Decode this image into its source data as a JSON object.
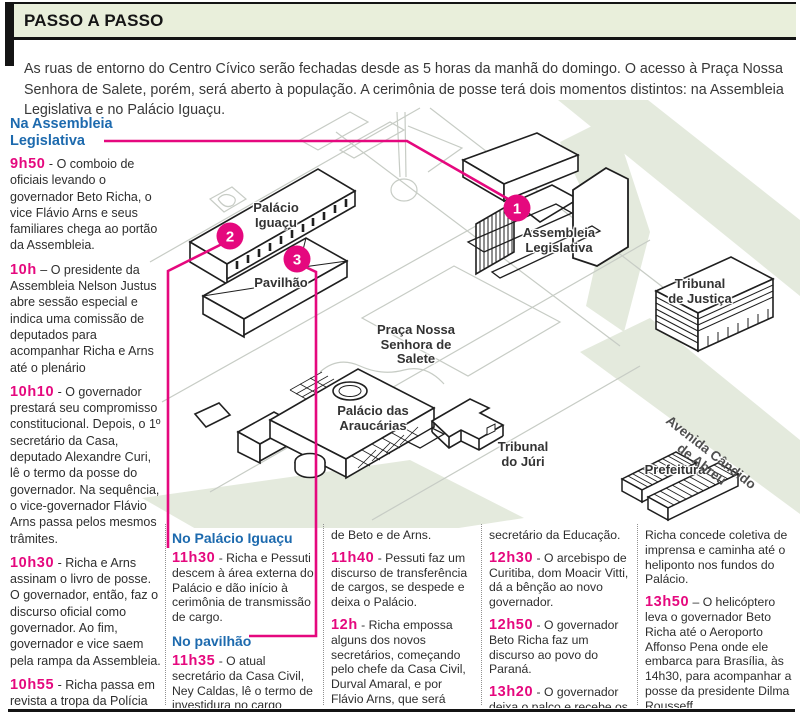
{
  "header": {
    "title": "PASSO A PASSO"
  },
  "intro": {
    "text": "As ruas de entorno do Centro Cívico serão fechadas desde as 5 horas da manhã do domingo. O acesso à Praça Nossa Senhora de Salete, porém,  será aberto à população. A cerimônia de posse terá dois momentos distintos: na Assembleia Legislativa e no Palácio Iguaçu."
  },
  "left_column": {
    "heading": "Na Assembleia\nLegislativa",
    "events": [
      {
        "time": "9h50",
        "sep": "-",
        "text": "O comboio de oficiais levando o governador Beto Richa, o vice Flávio Arns e seus familiares chega ao portão da Assembleia."
      },
      {
        "time": "10h",
        "sep": "–",
        "text": "O presidente da Assembleia Nelson Justus abre sessão especial e indica uma comissão de deputados para acompanhar Richa e Arns até o plenário"
      },
      {
        "time": "10h10",
        "sep": "-",
        "text": "O governador prestará seu compromisso constitucional. Depois, o 1º secretário da Casa, deputado Alexandre Curi, lê o termo da posse do governador. Na sequência, o vice-governador Flávio Arns passa pelos mesmos trâmites."
      },
      {
        "time": "10h30",
        "sep": "-",
        "text": "Richa e Arns assinam o livro de posse. O governador, então, faz o discurso oficial como governador. Ao fim, governador e vice saem pela rampa da Assembleia."
      },
      {
        "time": "10h55",
        "sep": "-",
        "text": "Richa passa em revista a tropa da Polícia Militar e se dirige ao saguão do Palácio Iguaçu."
      }
    ]
  },
  "bottom_columns": [
    {
      "blocks": [
        {
          "type": "heading",
          "text": "No Palácio Iguaçu"
        },
        {
          "type": "event",
          "time": "11h30",
          "sep": "-",
          "text": "Richa e Pessuti descem à área externa do Palácio e dão início à cerimônia de transmissão de cargo."
        },
        {
          "type": "heading",
          "text": "No pavilhão"
        },
        {
          "type": "event",
          "time": "11h35",
          "sep": "-",
          "text": "O atual secretário da Casa Civil, Ney Caldas, lê o termo de investidura no cargo"
        }
      ]
    },
    {
      "blocks": [
        {
          "type": "cont",
          "text": "de Beto e de Arns."
        },
        {
          "type": "event",
          "time": "11h40",
          "sep": "-",
          "text": "Pessuti faz um discurso de transferência de cargos, se despede e deixa o Palácio."
        },
        {
          "type": "event",
          "time": "12h",
          "sep": "-",
          "text": "Richa empossa alguns dos novos secretários, começando pelo chefe da Casa Civil, Durval Amaral, e por Flávio Arns, que será"
        }
      ]
    },
    {
      "blocks": [
        {
          "type": "cont",
          "text": "secretário da Educação."
        },
        {
          "type": "event",
          "time": "12h30",
          "sep": "-",
          "text": "O arcebispo de Curitiba, dom Moacir Vitti, dá a bênção ao novo governador."
        },
        {
          "type": "event",
          "time": "12h50",
          "sep": "-",
          "text": "O governador Beto Richa faz um discurso ao povo do Paraná."
        },
        {
          "type": "event",
          "time": "13h20",
          "sep": "-",
          "text": "O governador deixa o palco e recebe os cumprimentos da população."
        }
      ]
    },
    {
      "blocks": [
        {
          "type": "cont",
          "text": "Richa concede coletiva de imprensa e caminha até o heliponto nos fundos do Palácio."
        },
        {
          "type": "event",
          "time": "13h50",
          "sep": "–",
          "text": "O helicóptero leva o governador Beto Richa até o Aeroporto Affonso Pena onde ele embarca para Brasília, às 14h30, para acompanhar a posse da presidente Dilma Rousseff."
        }
      ]
    }
  ],
  "map": {
    "labels": {
      "palacio_iguacu": "Palácio\nIguaçu",
      "pavilhao": "Pavilhão",
      "assembleia": "Assembleia\nLegislativa",
      "tribunal_justica": "Tribunal\nde Justiça",
      "praca": "Praça Nossa\nSenhora de\nSalete",
      "araucarias": "Palácio das\nAraucárias",
      "tribunal_juri": "Tribunal\ndo Júri",
      "prefeitura": "Prefeitura",
      "avenida": "Avenida Cândido\nde Abreu"
    },
    "markers": {
      "m1": "1",
      "m2": "2",
      "m3": "3"
    }
  },
  "colors": {
    "accent_pink": "#e5087e",
    "heading_blue": "#1d6aae",
    "band_green": "#e9efdb",
    "map_green": "#e4eadd"
  }
}
